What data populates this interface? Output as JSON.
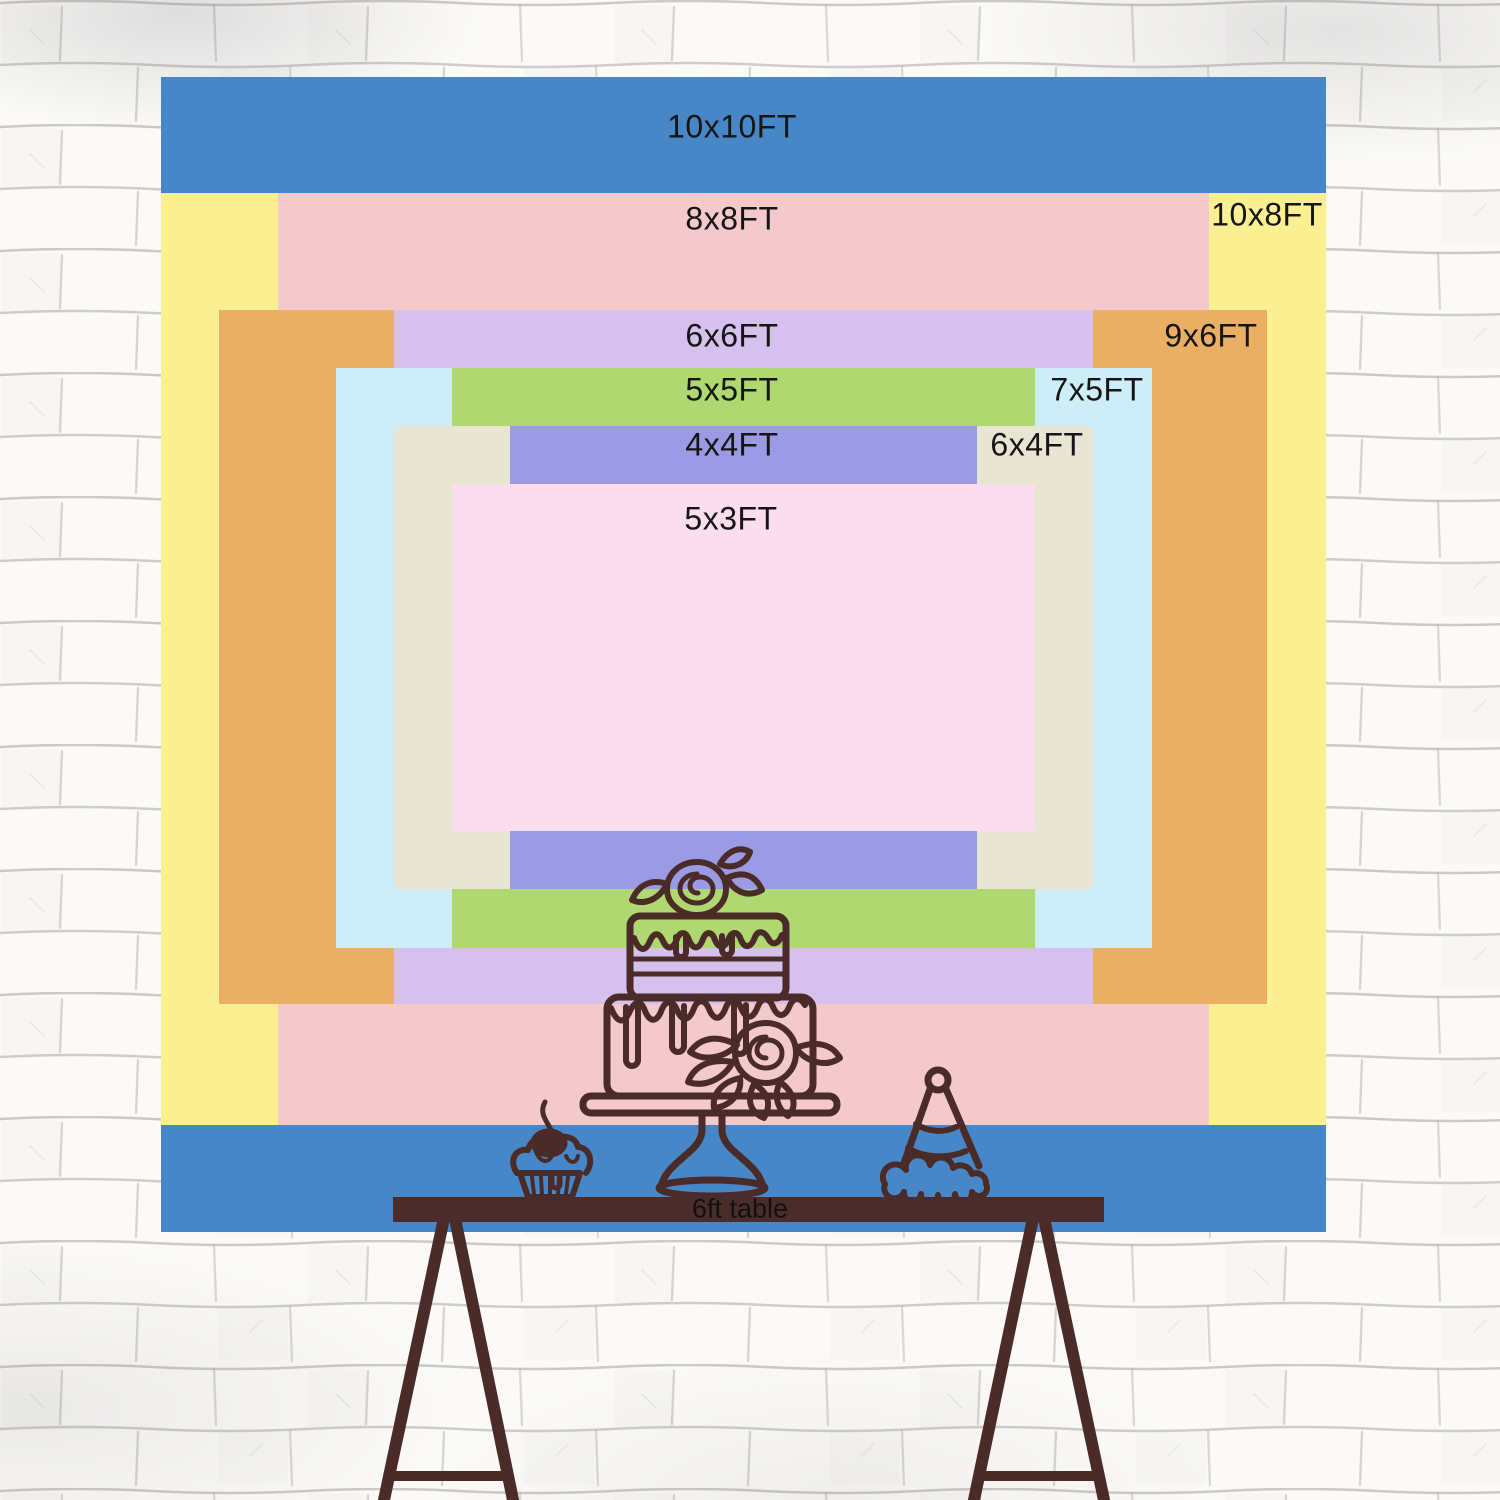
{
  "wall": {
    "color": "#fbfaf8",
    "mortar_color": "#b3afaa"
  },
  "backdrop": {
    "label_color": "#151515",
    "sizes": [
      {
        "id": "10x10",
        "label": "10x10FT",
        "color": "#4887c7"
      },
      {
        "id": "10x8",
        "label": "10x8FT",
        "color": "#faf092"
      },
      {
        "id": "8x8",
        "label": "8x8FT",
        "color": "#f4c9cb"
      },
      {
        "id": "9x6",
        "label": "9x6FT",
        "color": "#eaaf62"
      },
      {
        "id": "6x6",
        "label": "6x6FT",
        "color": "#d6c0ee"
      },
      {
        "id": "7x5",
        "label": "7x5FT",
        "color": "#cdeef8"
      },
      {
        "id": "5x5",
        "label": "5x5FT",
        "color": "#b0d871"
      },
      {
        "id": "6x4",
        "label": "6x4FT",
        "color": "#e9e5d3"
      },
      {
        "id": "4x4",
        "label": "4x4FT",
        "color": "#9b9ae4"
      },
      {
        "id": "5x3",
        "label": "5x3FT",
        "color": "#fbdeee"
      }
    ]
  },
  "table": {
    "label": "6ft table",
    "label_color": "#111111",
    "wood_color": "#4a2c2a"
  },
  "decor": {
    "ink_color": "#4a2b28",
    "items": [
      "tiered-cake",
      "cupcake-with-cherry",
      "party-hat",
      "trestle-table-legs"
    ]
  }
}
